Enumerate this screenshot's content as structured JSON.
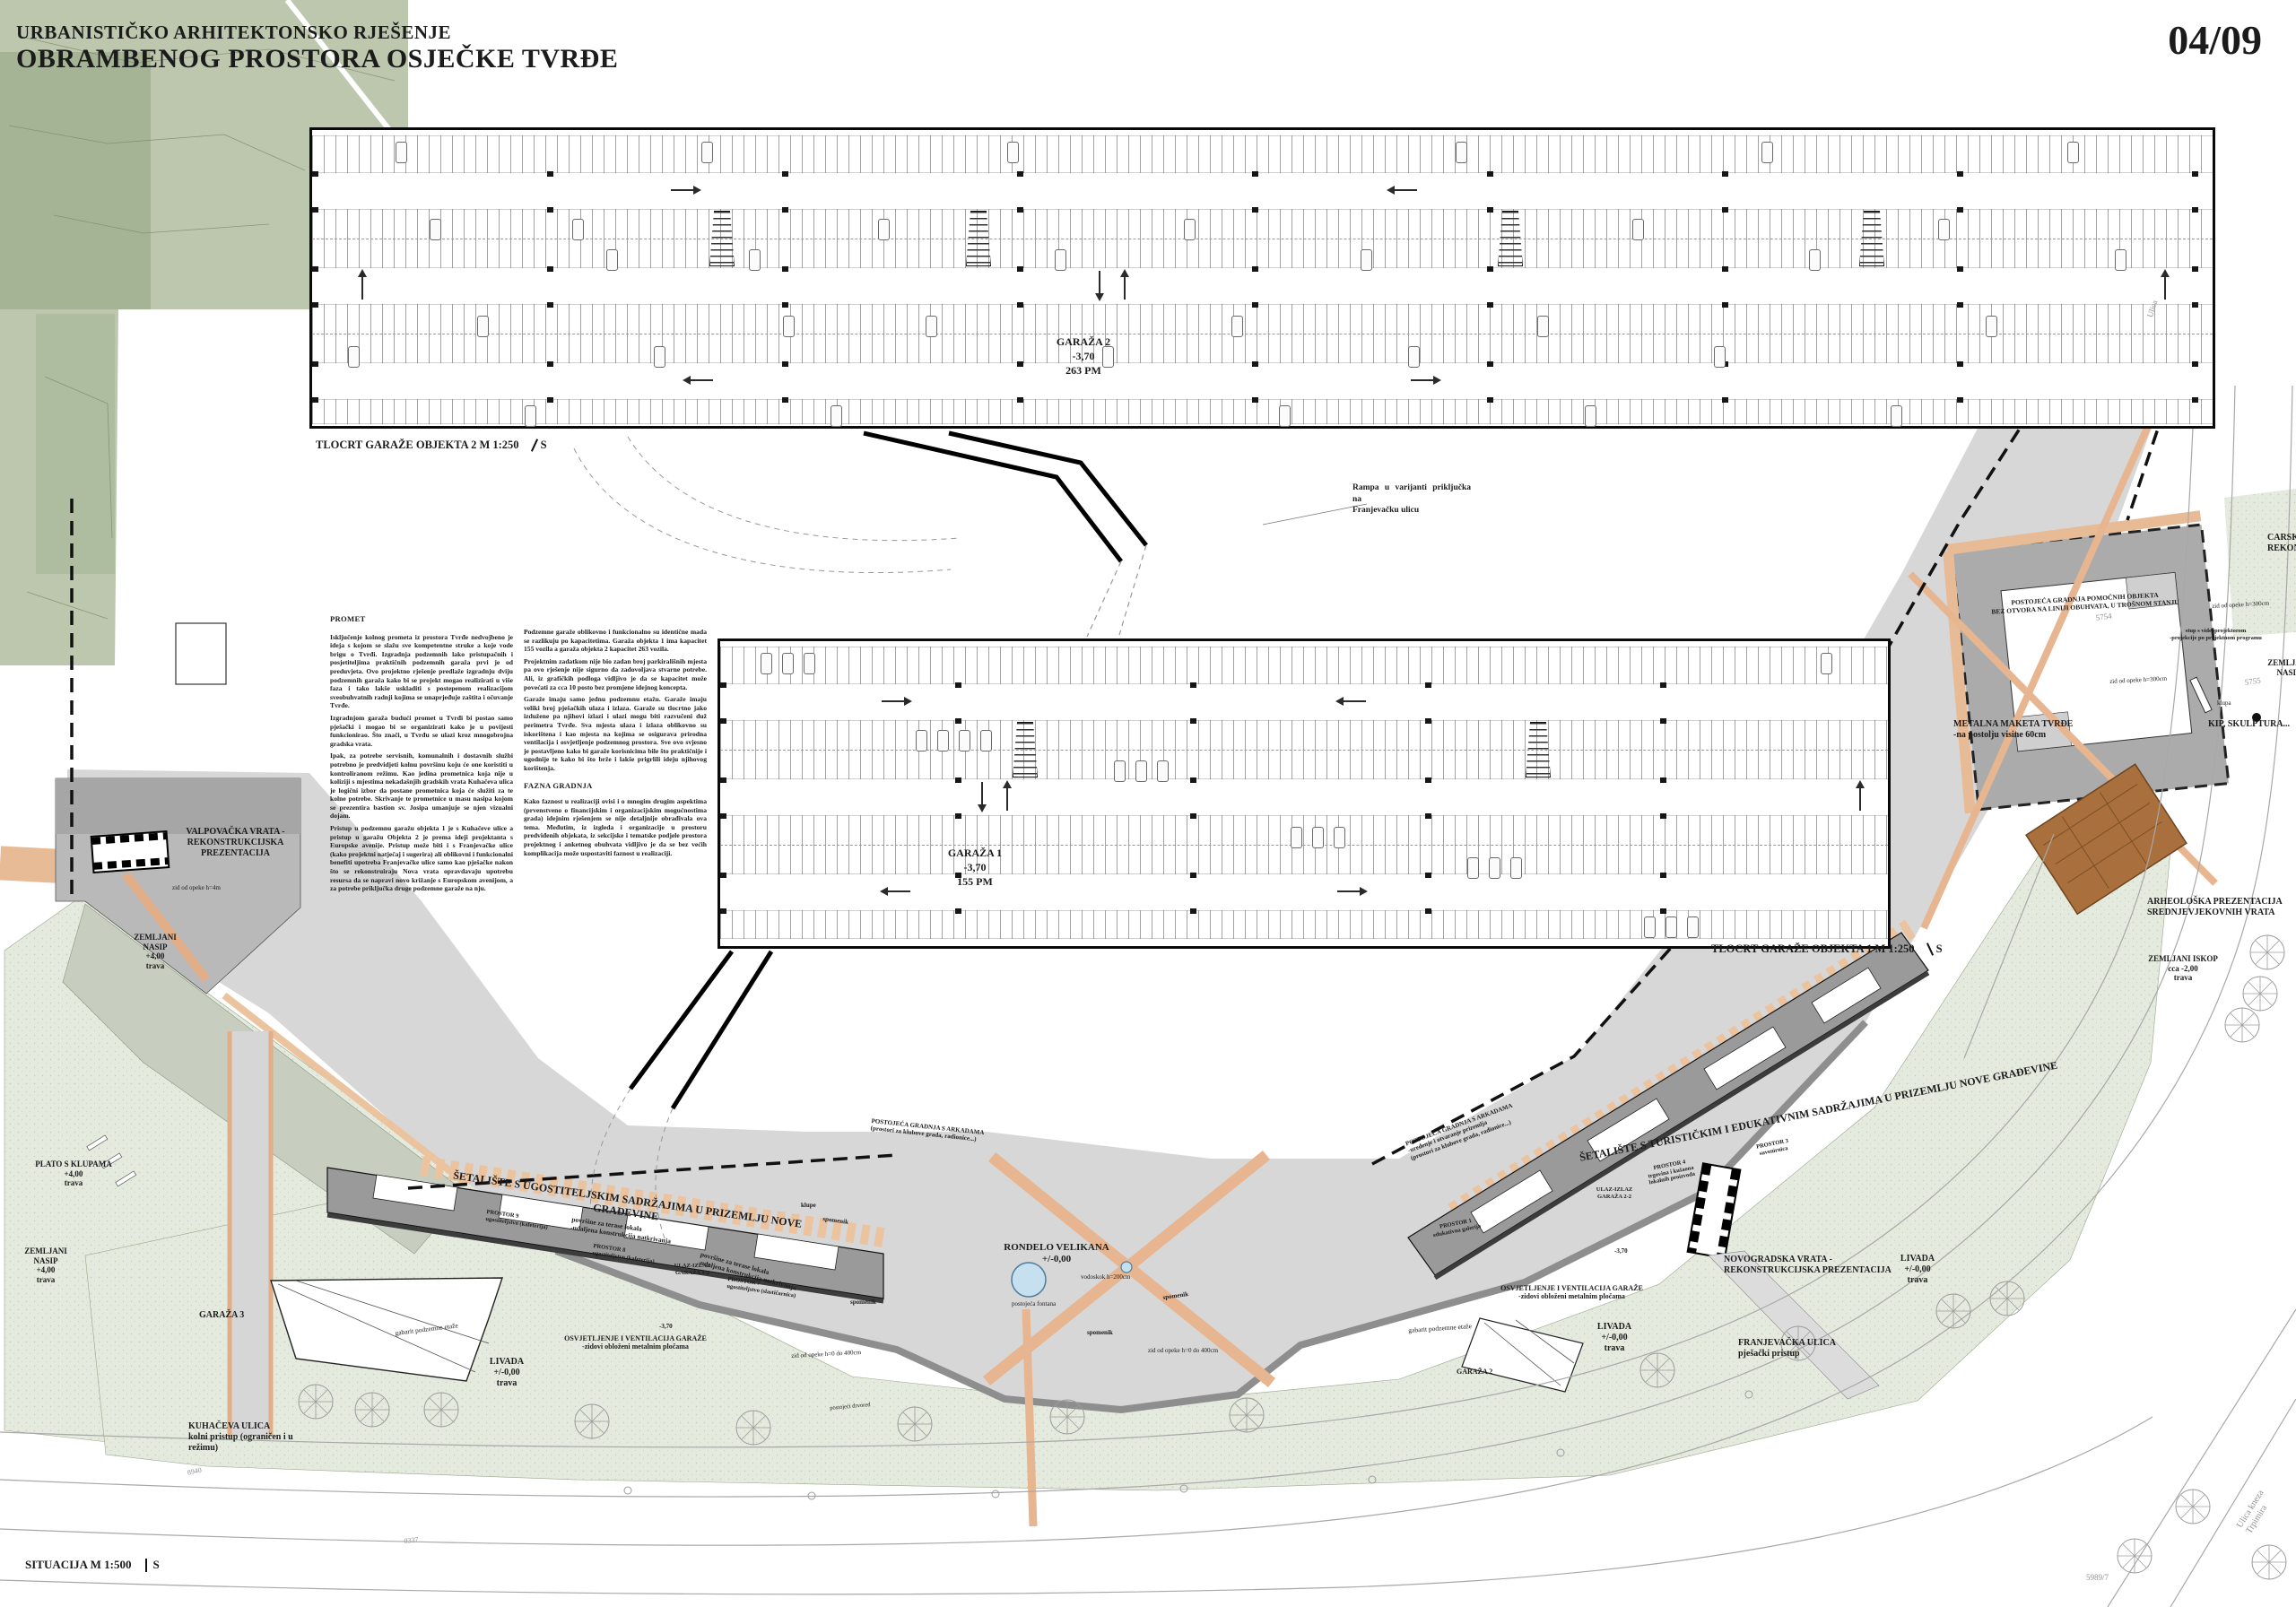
{
  "sheet": {
    "title_line1": "URBANISTIČKO ARHITEKTONSKO RJEŠENJE",
    "title_line2": "OBRAMBENOG PROSTORA OSJEČKE TVRĐE",
    "page_number": "04/09"
  },
  "plans": {
    "garage2": {
      "name": "GARAŽA 2",
      "level": "-3,70",
      "capacity": "263 PM",
      "caption": "TLOCRT GARAŽE OBJEKTA 2 M 1:250",
      "north": "S"
    },
    "garage1": {
      "name": "GARAŽA 1",
      "level": "-3,70",
      "capacity": "155 PM",
      "caption": "TLOCRT GARAŽE OBJEKTA 1 M 1:250",
      "north": "S"
    },
    "situation_caption": "SITUACIJA M 1:500",
    "situation_north": "S",
    "ramp_note": "Rampa u varijanti priključka na\nFranjevačku ulicu"
  },
  "text_block": {
    "heading1": "PROMET",
    "col1": [
      "Isključenje kolnog prometa iz prostora Tvrđe nedvojbeno je ideja s kojom se slažu sve kompetentne struke a koje vode brigu o Tvrđi. Izgradnja podzemnih lako pristupačnih i posjetiteljima praktičnih podzemnih garaža prvi je od preduvjeta. Ovo projektno rješenje predlaže izgradnju dviju podzemnih garaža kako bi se projekt mogao realizirati u više faza i tako lakše uskladiti s postepenom realizacijom sveobuhvatnih radnji kojima se unaprjeđuje zaštita i očuvanje Tvrđe.",
      "Izgradnjom garaža budući promet u Tvrđi bi postao samo pješački i mogao bi se organizirati kako je u povijesti funkcionirao. Što znači, u Tvrđu se ulazi kroz mnogobrojna gradska vrata.",
      "Ipak, za potrebe servisnih, komunalnih i dostavnih službi potrebno je predvidjeti kolnu površinu koju će one koristiti u kontroliranom režimu. Kao jedina prometnica koja nije u koliziji s mjestima nekadašnjih gradskih vrata Kuhačeva ulica je logični izbor da postane prometnica koja će služiti za te kolne potrebe. Skrivanje te prometnice u masu nasipa kojom se prezentira bastion sv. Josipa umanjuje se njen vizualni dojam.",
      "Pristup u podzemnu garažu objekta 1 je s Kuhačeve ulice a pristup u garažu Objekta 2 je prema ideji projektanta s Europske avenije. Pristup može biti i s Franjevačke ulice (kako projektni natječaj i sugerira) ali oblikovni i funkcionalni benefiti upotreba Franjevačke ulice samo kao pješačke nakon što se rekonstruiraju Nova vrata opravdavaju upotrebu resursa da se napravi novo križanje s Europskom avenijom, a za potrebe priključka druge podzemne garaže na nju."
    ],
    "col2a": [
      "Podzemne garaže oblikovno i funkcionalno su identične mada se razlikuju po kapacitetima. Garaža objekta 1 ima kapacitet 155 vozila a garaža objekta 2 kapacitet 263 vozila.",
      "Projektnim zadatkom nije bio zadan broj parkirališnih mjesta pa ovo rješenje nije sigurno da zadovoljava stvarne potrebe. Ali, iz grafičkih podloga vidljivo je da se kapacitet može povećati za cca 10 posto bez promjene idejnog koncepta.",
      "Garaže imaju samo jednu podzemnu etažu. Garaže imaju veliki broj pješačkih ulaza i izlaza. Garaže su tlocrtno jako izdužene pa njihovi izlazi i ulazi mogu biti razvučeni duž perimetra Tvrđe. Sva mjesta ulaza i izlaza oblikovno su iskorištena i kao mjesta na kojima se osigurava prirodna ventilacija i osvjetljenje podzemnog prostora. Sve ovo svjesno je postavljeno kako bi garaže korisnicima bile što praktičnije i ugodnije te kako bi što brže i lakše prigrlili ideju njihovog korištenja."
    ],
    "heading2": "FAZNA GRADNJA",
    "col2b": [
      "Kako faznost u realizaciji ovisi i o mnogim drugim aspektima (prvenstveno o financijskim i organizacijskim mogućnostima grada) idejnim rješenjem se nije detaljnije obrađivala ova tema. Međutim, iz izgleda i organizacije u prostoru predviđenih objekata, iz sekcijske i tematske podjele prostora projektnog i anketnog obuhvata vidljivo je da se bez većih komplikacija može uspostaviti faznost u realizaciji."
    ]
  },
  "labels": {
    "valpovacka": "VALPOVAČKA VRATA -\nREKONSTRUKCIJSKA\nPREZENTACIJA",
    "zid_opeke_4m": "zid od opeke h=4m",
    "zemljani_nasip_1": "ZEMLJANI\nNASIP\n+4,00\ntrava",
    "plato_s_klupama": "PLATO S KLUPAMA\n+4,00\ntrava",
    "zemljani_nasip_2": "ZEMLJANI\nNASIP\n+4,00\ntrava",
    "garaza_3": "GARAŽA 3",
    "livada_left": "LIVADA\n+/-0,00\ntrava",
    "kuhaceva_ulica": "KUHAČEVA ULICA\nkolni pristup (ograničen i u\nrežimu)",
    "gabarit_left": "gabarit podzemne etaže",
    "osvjetljenje_left": "OSVJETLJENJE I VENTILACIJA GARAŽE\n-zidovi obloženi metalnim pločama",
    "setaliste_left": "ŠETALIŠTE S UGOSTITELJSKIM SADRŽAJIMA U PRIZEMLJU NOVE\nGRAĐEVINE",
    "povrsine_terase_left": "površine za terase lokala\n-udaljena konstrukcija natkrivanja",
    "prostor_9": "PROSTOR 9\nugostiteljstvo (kafeterija)",
    "prostor_8": "PROSTOR 8\nugostiteljstvo (kafeterija)",
    "prostor_7": "PROSTOR 7\nugostiteljstvo (slastičarnica)",
    "ulaz_izlaz_1_2": "ULAZ-IZLAZ\nGARAŽA 1-2",
    "minus_370_left": "-3,70",
    "povrsine_terase_right": "površine za terase lokala\n-udaljena konstrukcija natkrivanja",
    "klupe": "klupe",
    "spomenik_1": "spomenik",
    "spomenik_2": "spomenik",
    "spomenik_3": "spomenik",
    "spomenik_4": "spomenik",
    "postojeci_drvored": "postojeći drvored",
    "zid_opeke_0_400_left": "zid od opeke h=0 do 400cm",
    "rondelo": "RONDELO VELIKANA\n+/-0,00",
    "vodoskok": "vodoskok h=200cm",
    "postojeca_fontana": "postojeća fontana",
    "zid_opeke_0_400_mid": "zid od opeke h=0 do 400cm",
    "arkade_1": "POSTOJEĆA GRADNJA S ARKADAMA\n-uređenje i otvaranje prizemlja\n(prostori za klubove grada, radionice...)",
    "arkade_2": "POSTOJEĆA GRADNJA S ARKADAMA\n(prostori za klubove grada, radionice...)",
    "setaliste_right": "ŠETALIŠTE S TURISTIČKIM I EDUKATIVNIM SADRŽAJIMA U PRIZEMLJU NOVE GRAĐEVINE",
    "prostor_1": "PROSTOR 1\nedukativna galerija",
    "prostor_3": "PROSTOR 3\nsuvenirnica",
    "prostor_4": "PROSTOR 4\ntrgovina i kušaona\nlokalnih proizvoda",
    "ulaz_izlaz_2_2": "ULAZ-IZLAZ\nGARAŽA 2-2",
    "minus_370_right": "-3,70",
    "osvjetljenje_right": "OSVJETLJENJE I VENTILACIJA GARAŽE\n-zidovi obloženi metalnim pločama",
    "gabarit_right": "gabarit podzemne etaže",
    "livada_mid": "LIVADA\n+/-0,00\ntrava",
    "garaza_2_site": "GARAŽA 2",
    "novogradska": "NOVOGRADSKA VRATA -\nREKONSTRUKCIJSKA PREZENTACIJA",
    "livada_right": "LIVADA\n+/-0,00\ntrava",
    "franjevacka_ulica": "FRANJEVAČKA ULICA\npješački pristup",
    "arheoloska": "ARHEOLOŠKA PREZENTACIJA\nSREDNJEVJEKOVNIH VRATA",
    "zemljani_iskop": "ZEMLJANI ISKOP\ncca -2,00\ntrava",
    "postojeca_pomocnih": "POSTOJEĆA GRADNJA POMOĆNIH OBJEKTA\nBEZ OTVORA NA LINIJI OBUHVATA, U TROŠNOM STANJU",
    "zid_opeke_300_1": "zid od opeke h=300cm",
    "zid_opeke_300_2": "zid od opeke h=300cm",
    "stup_video": "stup s videoprojektorom\n-projekcije po projektnom programu",
    "metalna_maketa": "METALNA MAKETA TVRĐE\n-na postolju visine 60cm",
    "kip_skulptura": "KIP, SKULPTURA...",
    "klupa": "klupa",
    "carska": "CARSKA\nREKON",
    "zemljani_nasip_right": "ZEMLJANI\nNASIP",
    "p5754": "5754",
    "p5755": "5755",
    "p5989": "5989/7",
    "c0337": "0337",
    "c8940": "8940",
    "ulica_top": "Ulica",
    "ulica_kneza": "Ulica kneza Trpimira"
  }
}
